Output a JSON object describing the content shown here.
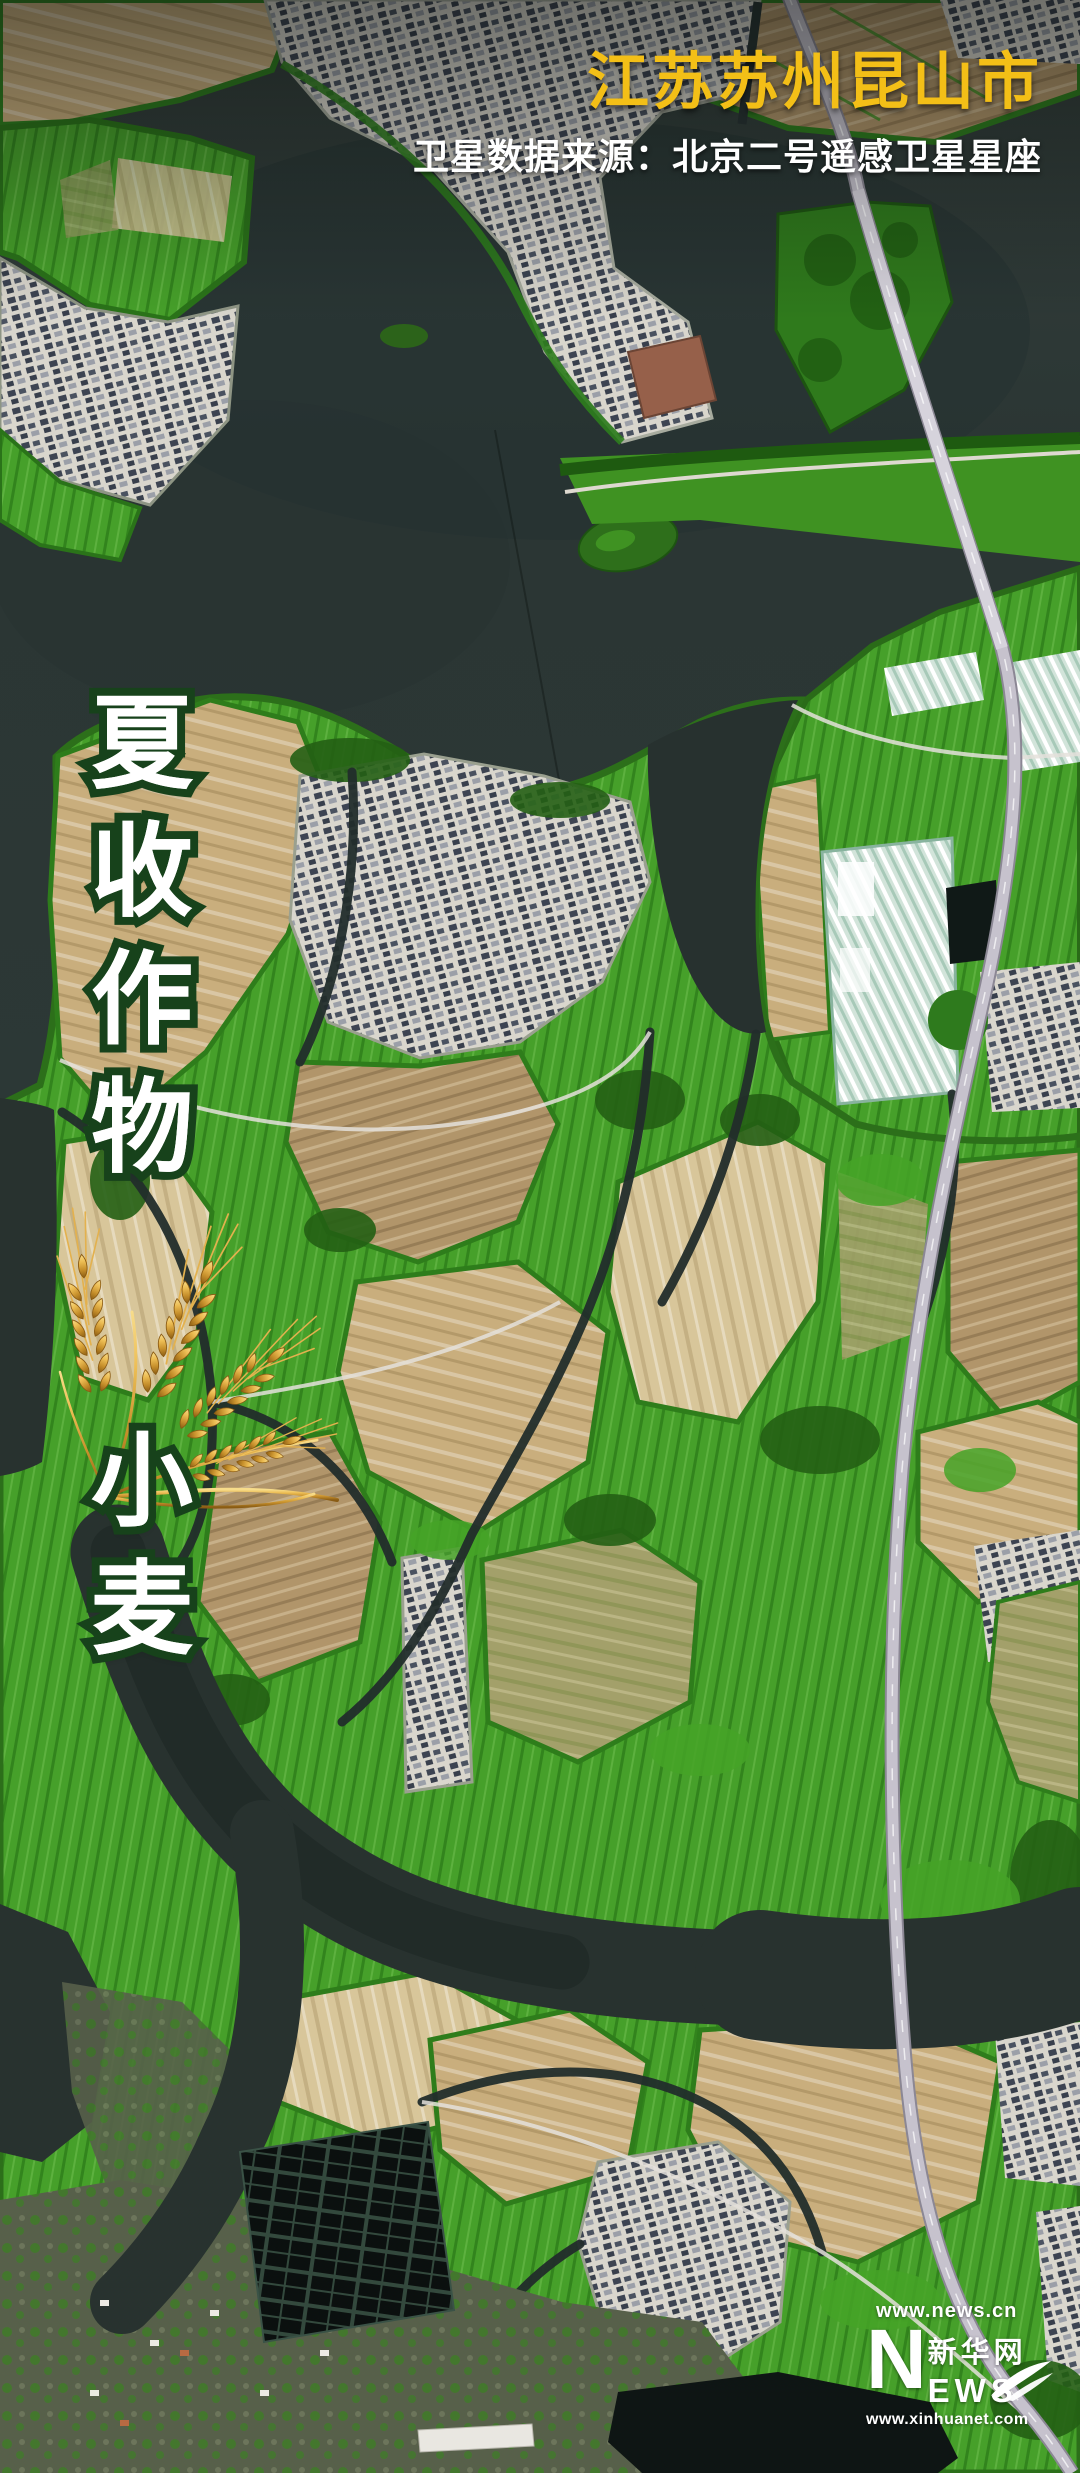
{
  "header": {
    "title": "江苏苏州昆山市",
    "subtitle": "卫星数据来源：北京二号遥感卫星星座"
  },
  "vertical_labels": {
    "column1": {
      "text": "夏收作物",
      "chars": [
        "夏",
        "收",
        "作",
        "物"
      ]
    },
    "column2": {
      "text": "小麦",
      "chars": [
        "小",
        "麦"
      ]
    }
  },
  "logo": {
    "url_top": "www.news.cn",
    "n": "N",
    "cn": "新华网",
    "ews": "EWS",
    "url_bottom": "www.xinhuanet.com"
  },
  "icons": {
    "wheat": "wheat-ear-icon",
    "swoosh": "xinhua-swoosh-icon"
  },
  "palette": {
    "title_yellow": "#F3BF17",
    "label_fill": "#FFFFFF",
    "label_outline": "#17421B",
    "water_dark": "#2C3836",
    "field_tan": "#C9AE7D",
    "vegetation_green": "#46A02A",
    "village_gray": "#D9D6CD",
    "road_gray": "#C6C2CD",
    "wheat_gold": "#EDBE55"
  }
}
